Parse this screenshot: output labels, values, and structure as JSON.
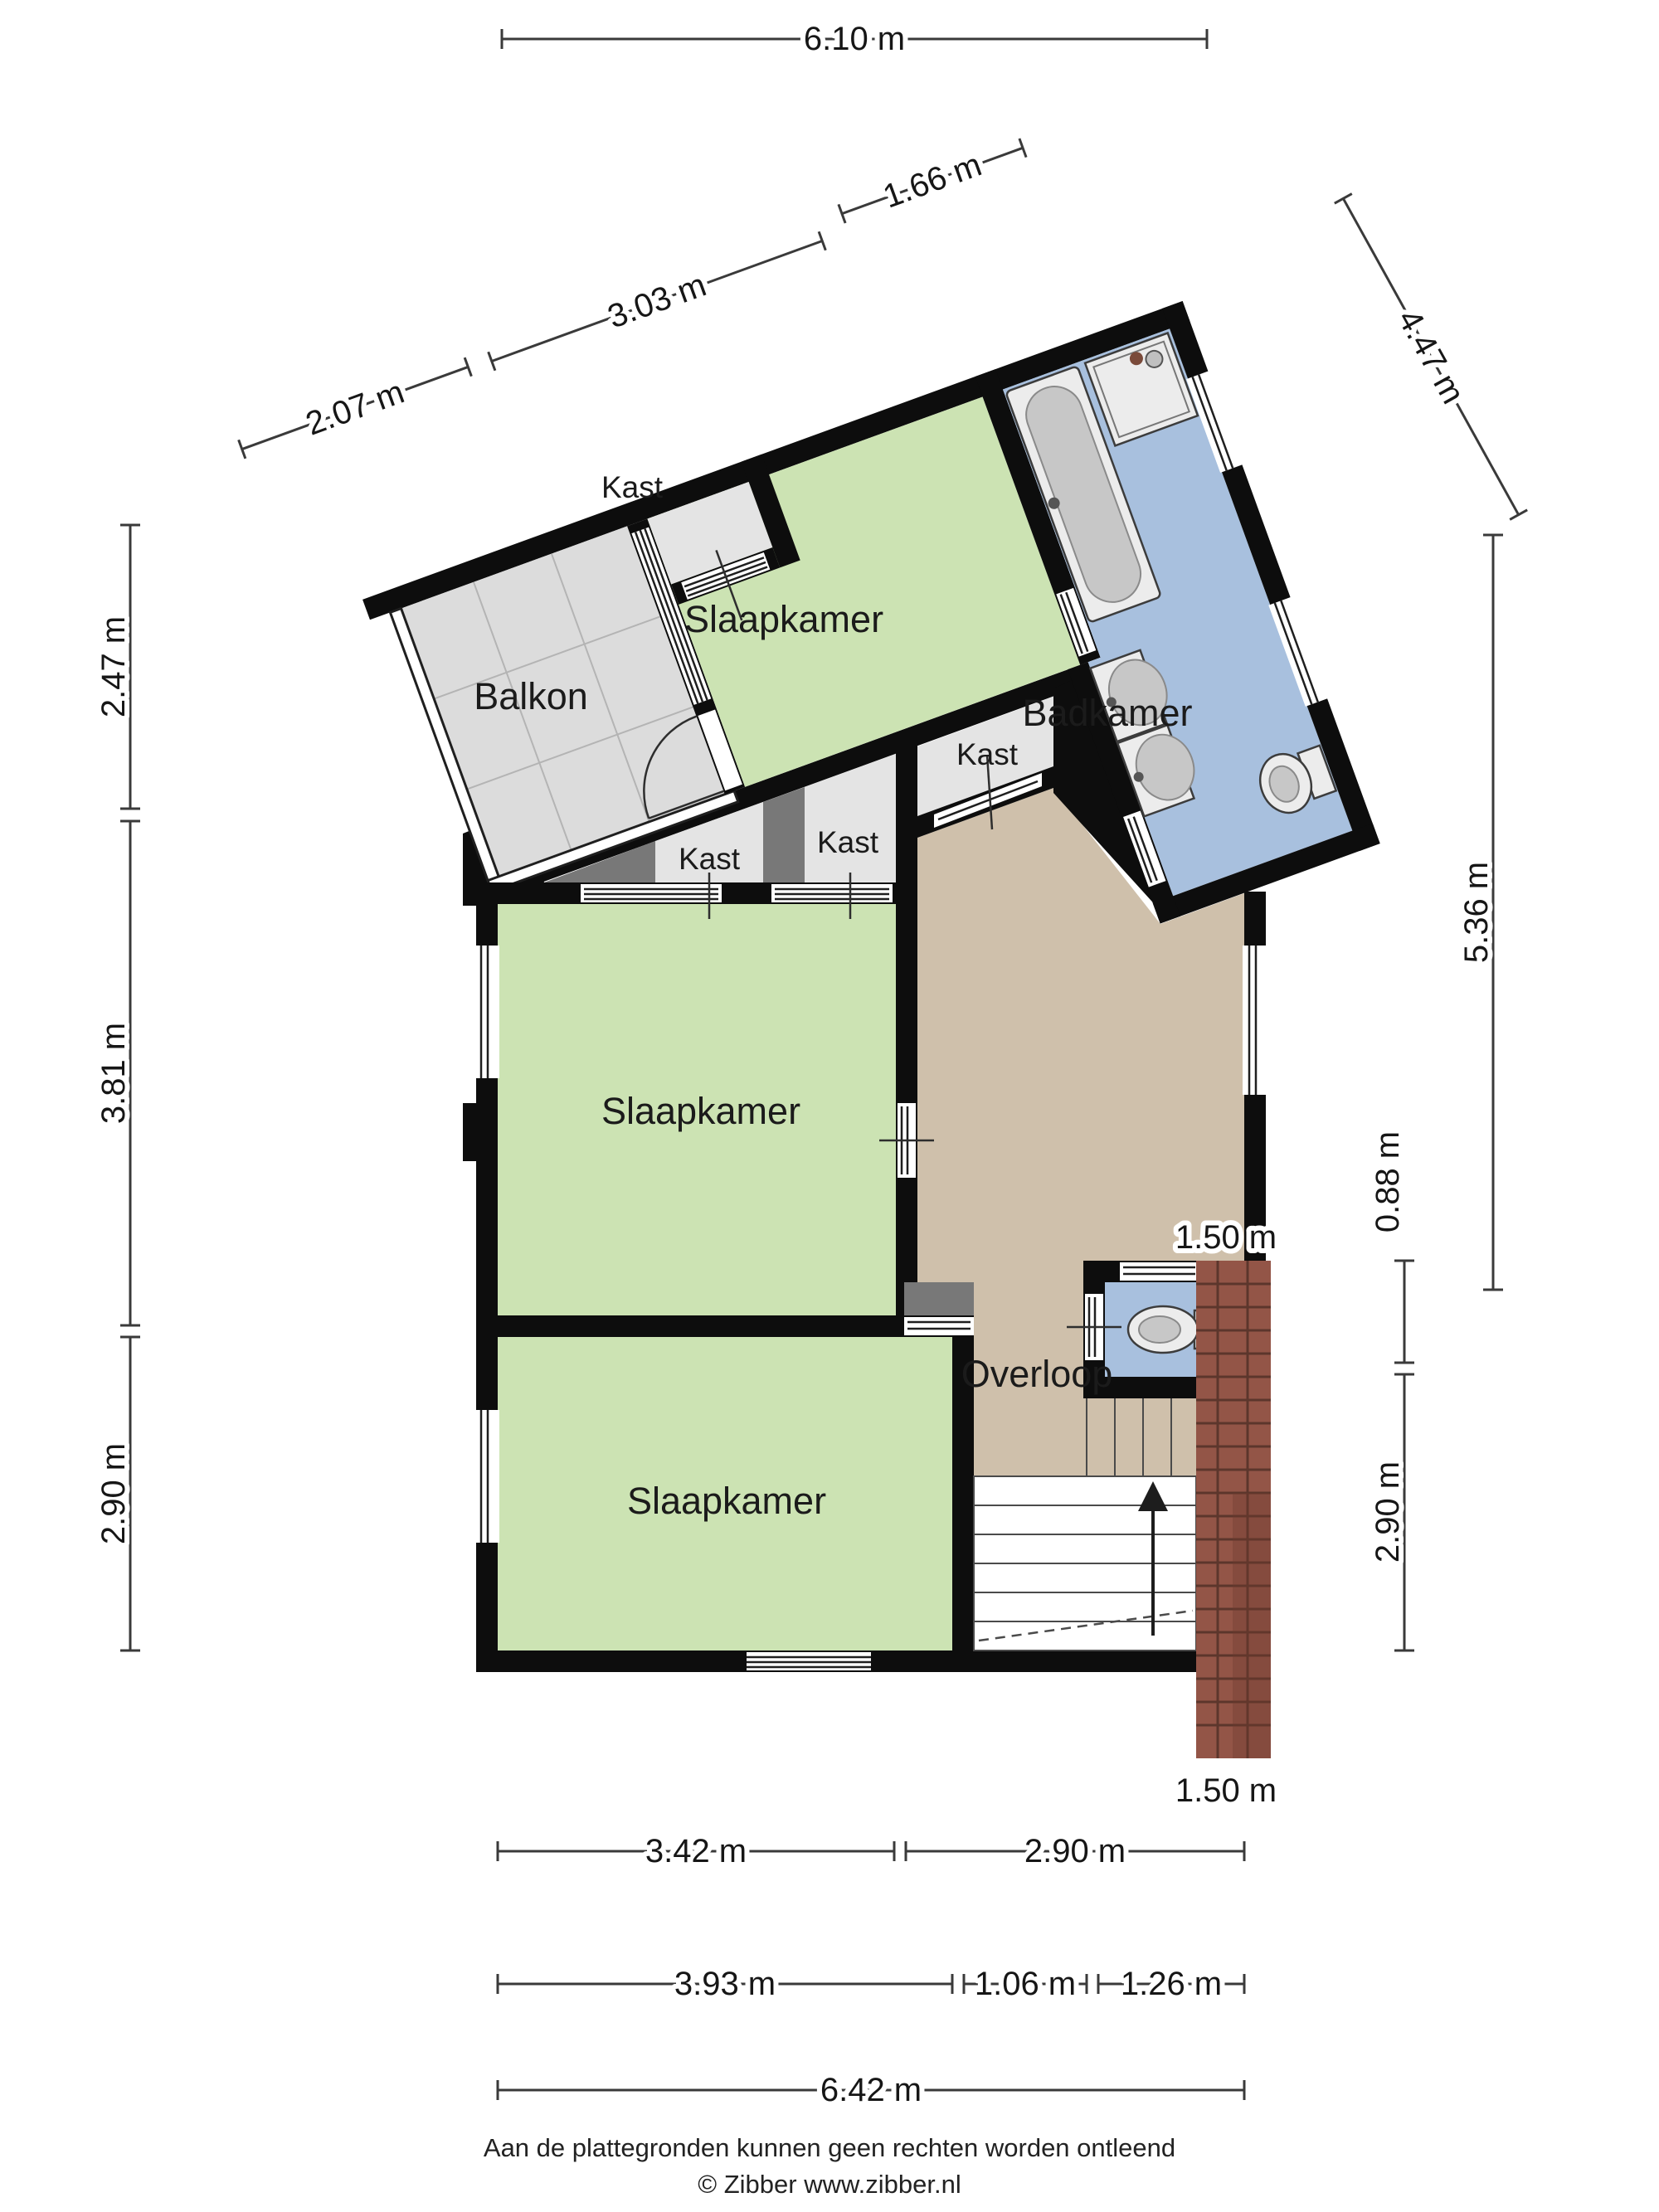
{
  "labels": {
    "balkon": "Balkon",
    "kast": "Kast",
    "slaapkamer": "Slaapkamer",
    "badkamer": "Badkamer",
    "overloop": "Overloop"
  },
  "dims": {
    "top": "6.10 m",
    "diag_a": "1.66 m",
    "diag_b": "3.03 m",
    "diag_c": "2.07 m",
    "diag_right": "4.47 m",
    "left_a": "2.47 m",
    "left_b": "3.81 m",
    "left_c": "2.90 m",
    "right_a": "5.36 m",
    "right_b": "0.88 m",
    "right_c": "2.90 m",
    "roof_top": "1.50 m",
    "roof_bottom": "1.50 m",
    "bottom_a": "3.42 m",
    "bottom_b": "2.90 m",
    "bottom_c": "3.93 m",
    "bottom_d": "1.06 m",
    "bottom_e": "1.26 m",
    "bottom_f": "6.42 m"
  },
  "footer": {
    "disclaimer": "Aan de plattegronden kunnen geen rechten worden ontleend",
    "credit": "© Zibber www.zibber.nl"
  },
  "colors": {
    "room_green": "#cce3b3",
    "bathroom_blue": "#a8c0de",
    "hall_tan": "#cfc0ab",
    "balcony_gray": "#dcdcdc",
    "closet_gray": "#e4e4e4",
    "divider_gray": "#787878",
    "wall_black": "#0d0d0d",
    "brick": "#935547"
  }
}
